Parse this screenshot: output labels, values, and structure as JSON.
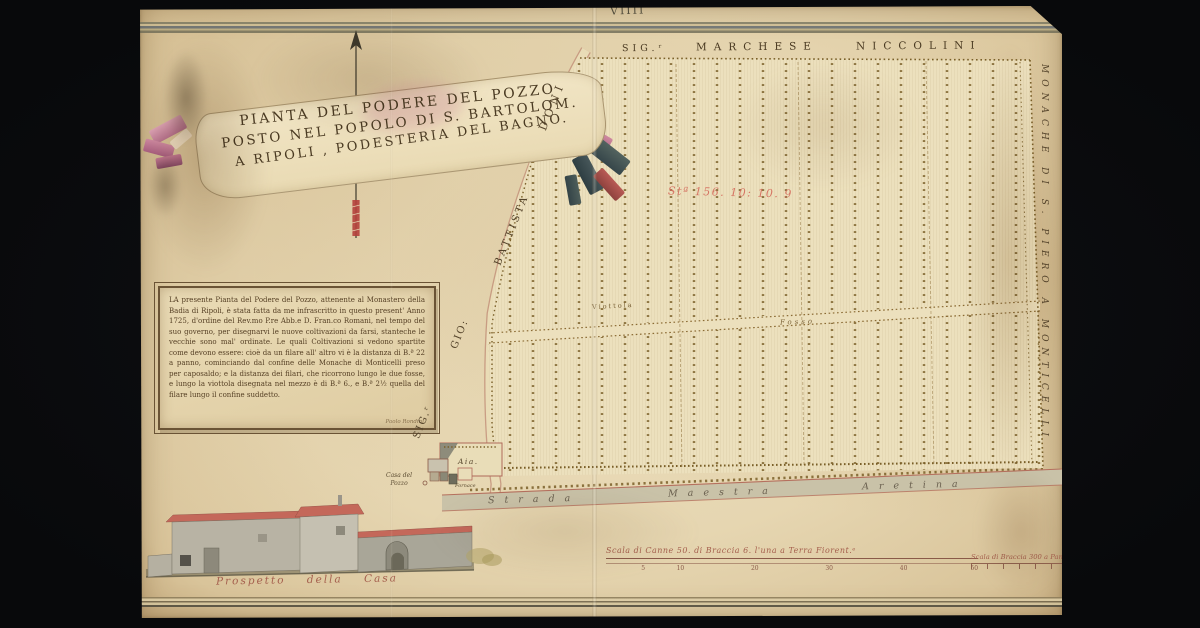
{
  "sheet": {
    "number": "VIIII"
  },
  "title_banner": {
    "line1": "PIANTA DEL PODERE DEL POZZO",
    "line2": "POSTO NEL POPOLO DI S. BARTOLOM.",
    "line3": "A RIPOLI , PODESTERIA DEL BAGNO."
  },
  "neighbors": {
    "top_parts": [
      "SIG.ʳ",
      "MARCHESE",
      "NICCOLINI"
    ],
    "right": "MONACHE DI S. PIERO A MONTICELLI"
  },
  "roads": {
    "left_parts": [
      "SIG.ʳ",
      "GIO:",
      "BATTISTA",
      "DONI"
    ],
    "bottom_words": [
      "Strada",
      "Maestra",
      "Aretina"
    ]
  },
  "field": {
    "red_note": "Stª 156. 10: 10. 9",
    "viottola": "Viottola",
    "fosso": "Fosso"
  },
  "farm": {
    "aia": "Aia.",
    "casa_line1": "Casa del",
    "casa_line2": "Pozzo",
    "fornace": "Fornace"
  },
  "cartouche": {
    "text": "LA presente Pianta del Podere del Pozzo, attenente al Monastero della Badia di Ripoli, è stata fatta da me infrascritto in questo present' Anno 1725, d'ordine del Rev.mo P.re Abb.e D. Fran.co Romani, nel tempo del suo governo, per disegnarvi le nuove coltivazioni da farsi, stanteche le vecchie sono mal' ordinate. Le quali Coltivazioni si vedono spartite come devono essere: cioè da un filare all' altro vi è la distanza di B.ª 22 a panno, cominciando dal confine delle Monache di Monticelli preso per caposaldo; e la distanza dei filari, che ricorrono lungo le due fosse, e lungo la viottola disegnata nel mezzo è di B.ª 6., e B.ª 2½ quella del filare lungo il confine suddetto.",
    "signature": "Paolo Rondini"
  },
  "elevation": {
    "caption": "Prospetto della Casa"
  },
  "scales": {
    "s1": {
      "label": "Scala di Canne 50. di Braccia 6. l'una a Terra Fiorent.ᵉ",
      "ticks": [
        "5",
        "10",
        "20",
        "30",
        "40",
        "50"
      ]
    },
    "s2": {
      "label": "Scala di Braccia 300 a Panno Fiorent.ᵒ"
    }
  },
  "colors": {
    "backdrop": "#0a0b0d",
    "parchment": "#e6d6b1",
    "ink": "#4d3b24",
    "red_ink": "#d4695a",
    "roof_red": "#c4685a",
    "tree_dot": "#7a5f28"
  }
}
